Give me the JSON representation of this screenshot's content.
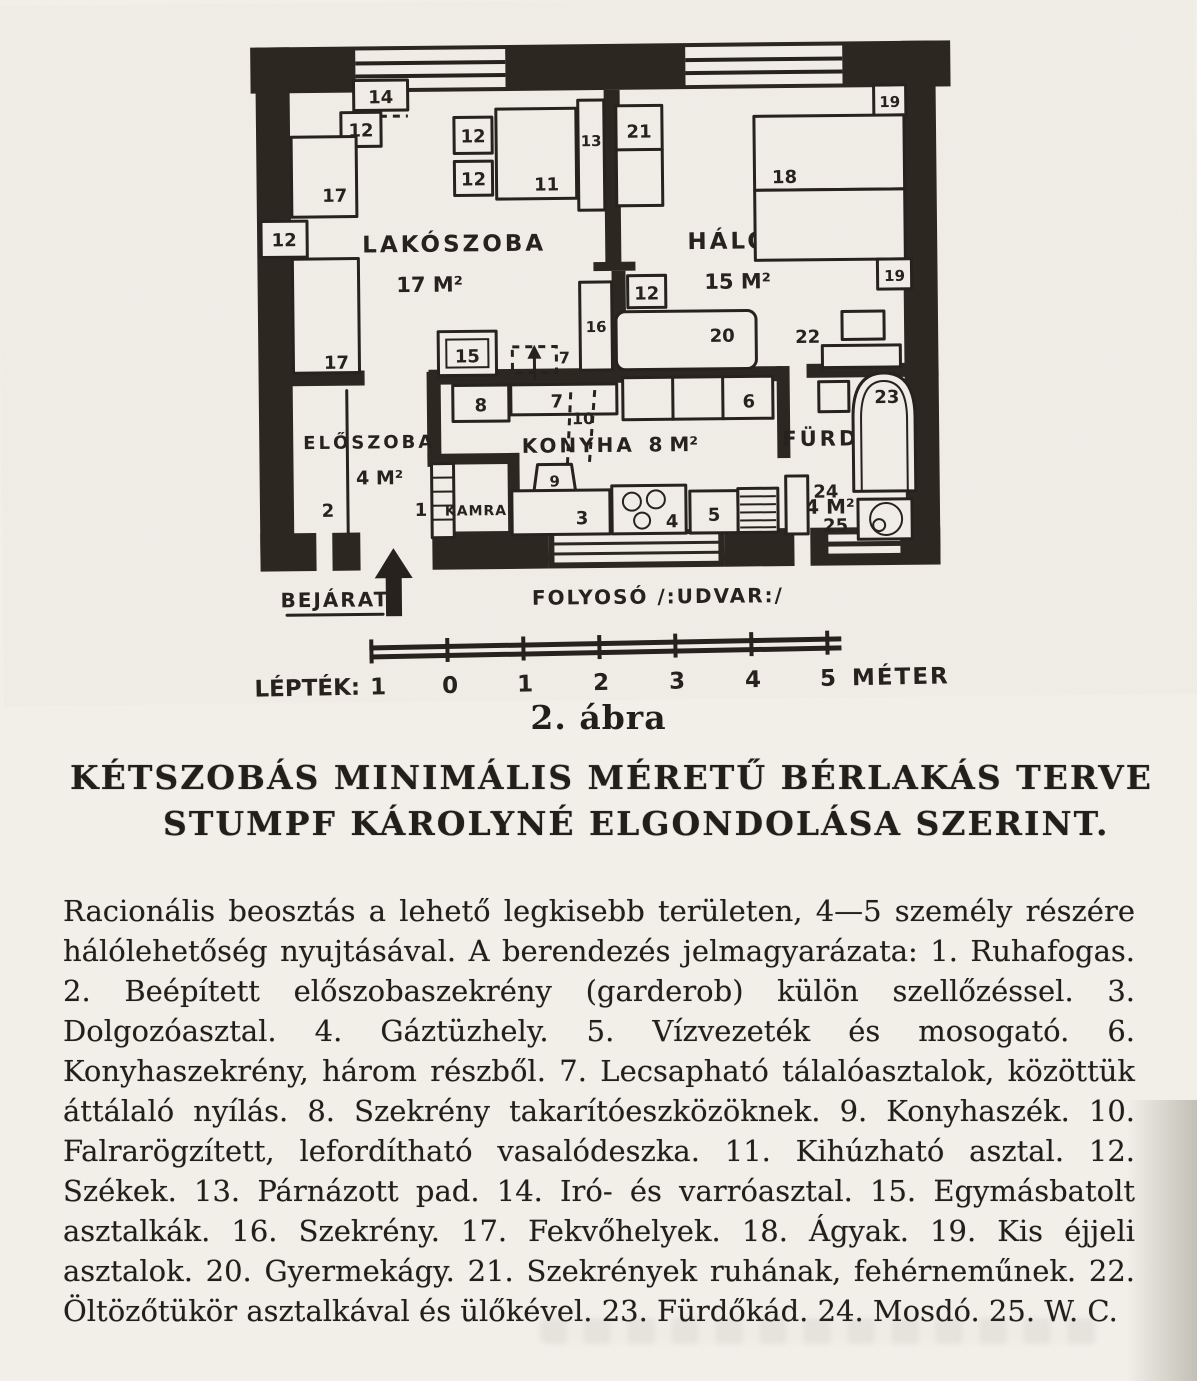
{
  "figure": {
    "plan": {
      "rooms": [
        {
          "name": "LAKÓSZOBA",
          "area": "17 M²"
        },
        {
          "name": "HÁLÓSZOBA",
          "area": "15 M²"
        },
        {
          "name": "ELŐSZOBA",
          "area": "4 M²"
        },
        {
          "name": "KONYHA",
          "area": "8 M²"
        },
        {
          "name": "FÜRDŐ",
          "area": "4 M²"
        },
        {
          "name": "KAMRA",
          "area": ""
        }
      ],
      "entrance_label": "BEJÁRAT",
      "corridor_label": "FOLYOSÓ /:UDVAR:/",
      "furniture": {
        "n1": "1",
        "n2": "2",
        "n3": "3",
        "n4": "4",
        "n5": "5",
        "n6": "6",
        "n7": "7",
        "n8": "8",
        "n9": "9",
        "n10": "10",
        "n11": "11",
        "n12": "12",
        "n13": "13",
        "n14": "14",
        "n15": "15",
        "n16": "16",
        "n17": "17",
        "n18": "18",
        "n19": "19",
        "n20": "20",
        "n21": "21",
        "n22": "22",
        "n23": "23",
        "n24": "24",
        "n25": "25"
      }
    },
    "scale": {
      "label": "LÉPTÉK:",
      "ticks": [
        "1",
        "0",
        "1",
        "2",
        "3",
        "4",
        "5"
      ],
      "unit": "MÉTER"
    },
    "caption": "2. ábra"
  },
  "title": {
    "line1": "KÉTSZOBÁS MINIMÁLIS MÉRETŰ BÉRLAKÁS TERVE",
    "line2": "STUMPF KÁROLYNÉ ELGONDOLÁSA SZERINT."
  },
  "legend": {
    "intro": "Racionális beosztás a lehető legkisebb területen, 4—5 személy részére hálólehetőség nyujtásával. A berendezés jelmagyarázata:",
    "items": [
      {
        "num": "1.",
        "text": "Ruhafogas."
      },
      {
        "num": "2.",
        "text": "Beépített előszobaszekrény (garderob) külön szellőzéssel."
      },
      {
        "num": "3.",
        "text": "Dolgozóasztal."
      },
      {
        "num": "4.",
        "text": "Gáztüzhely."
      },
      {
        "num": "5.",
        "text": "Vízvezeték és mosogató."
      },
      {
        "num": "6.",
        "text": "Konyhaszekrény, három részből."
      },
      {
        "num": "7.",
        "text": "Lecsapható tálalóasztalok, közöttük áttálaló nyílás."
      },
      {
        "num": "8.",
        "text": "Szekrény takarítóeszközöknek."
      },
      {
        "num": "9.",
        "text": "Konyhaszék."
      },
      {
        "num": "10.",
        "text": "Falrarögzített, lefordítható vasalódeszka."
      },
      {
        "num": "11.",
        "text": "Kihúzható asztal."
      },
      {
        "num": "12.",
        "text": "Székek."
      },
      {
        "num": "13.",
        "text": "Párnázott pad."
      },
      {
        "num": "14.",
        "text": "Iró- és varróasztal."
      },
      {
        "num": "15.",
        "text": "Egymásbatolt asztalkák."
      },
      {
        "num": "16.",
        "text": "Szekrény."
      },
      {
        "num": "17.",
        "text": "Fekvőhelyek."
      },
      {
        "num": "18.",
        "text": "Ágyak."
      },
      {
        "num": "19.",
        "text": "Kis éjjeli asztalok."
      },
      {
        "num": "20.",
        "text": "Gyermekágy."
      },
      {
        "num": "21.",
        "text": "Szekrények ruhának, fehérneműnek."
      },
      {
        "num": "22.",
        "text": "Öltözőtükör asztalkával és ülőkével."
      },
      {
        "num": "23.",
        "text": "Fürdőkád."
      },
      {
        "num": "24.",
        "text": "Mosdó."
      },
      {
        "num": "25.",
        "text": "W. C."
      }
    ]
  }
}
